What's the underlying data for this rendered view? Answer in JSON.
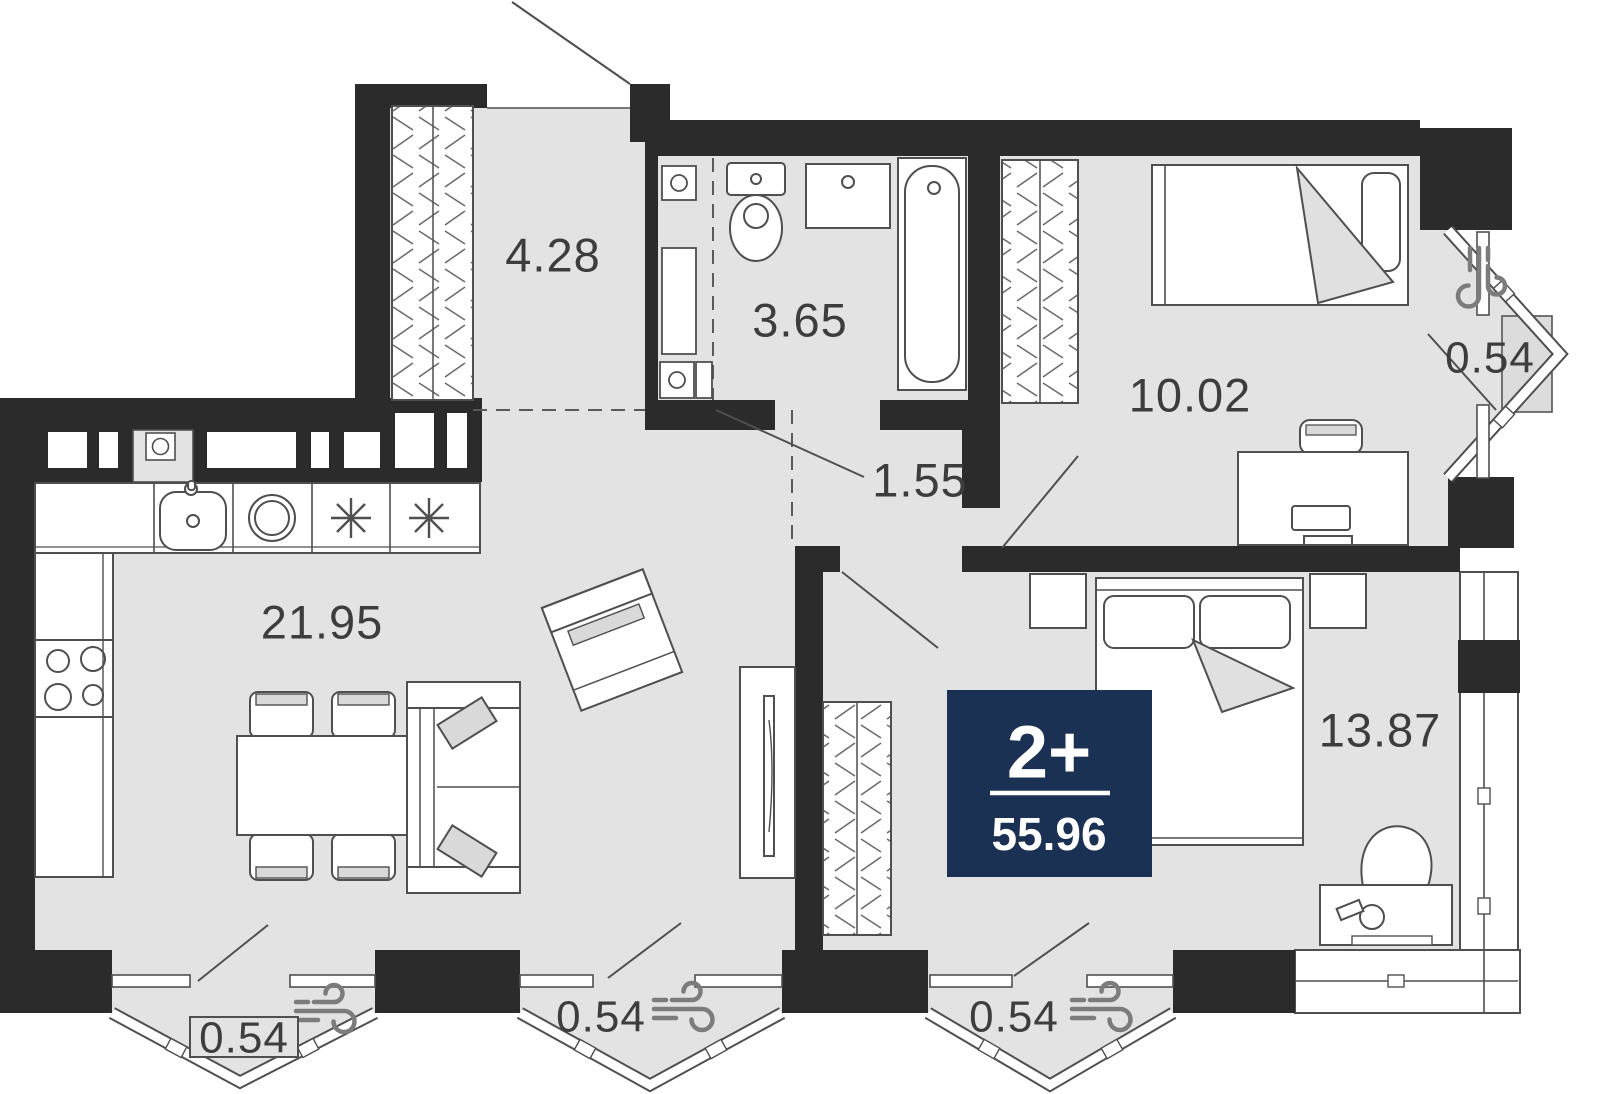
{
  "plan": {
    "type": "apartment-floor-plan",
    "badge": {
      "rooms_label": "2+",
      "total_area": "55.96"
    },
    "rooms": [
      {
        "name": "hallway",
        "area": "4.28"
      },
      {
        "name": "bathroom",
        "area": "3.65"
      },
      {
        "name": "corridor",
        "area": "1.55"
      },
      {
        "name": "bedroom",
        "area": "10.02"
      },
      {
        "name": "kitchen-living-room",
        "area": "21.95"
      },
      {
        "name": "master-bedroom",
        "area": "13.87"
      }
    ],
    "balconies": [
      {
        "name": "right-bay-window",
        "area": "0.54"
      },
      {
        "name": "bottom-left-bay-window",
        "area": "0.54"
      },
      {
        "name": "bottom-center-bay-window",
        "area": "0.54"
      },
      {
        "name": "bottom-right-bay-window",
        "area": "0.54"
      }
    ],
    "colors": {
      "wall": "#2b2b2b",
      "floor": "#e3e3e3",
      "badge_bg": "#1b3153",
      "badge_text": "#ffffff",
      "furniture_line": "#4f4f4f",
      "label": "#3d3d3d",
      "icon": "#7c7c7c",
      "accent_fill": "#d9d9d9"
    }
  }
}
